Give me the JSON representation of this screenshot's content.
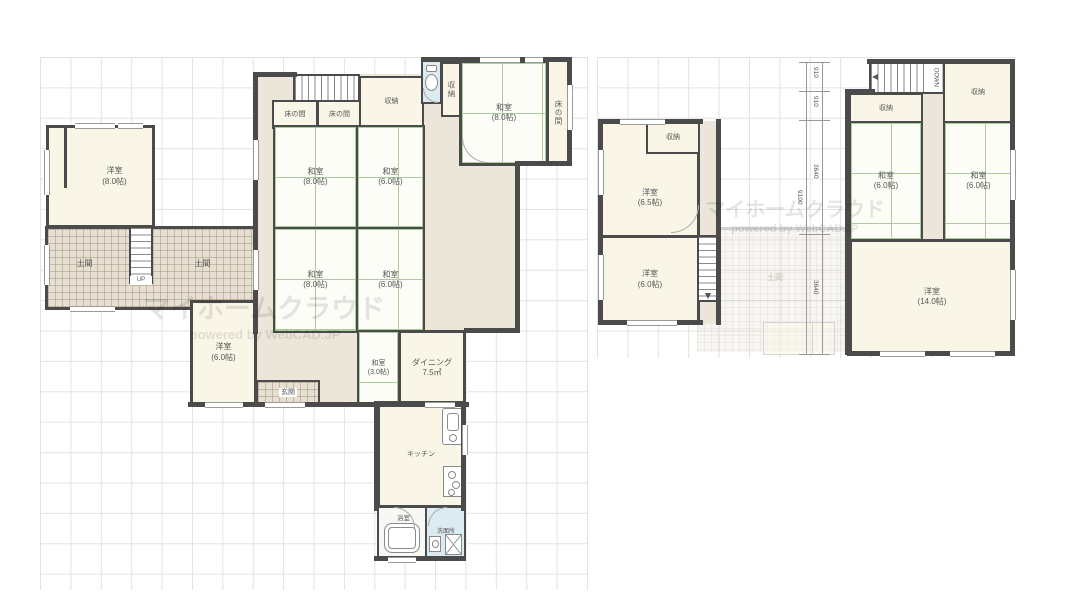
{
  "watermark": {
    "title": "マイホームクラウド",
    "subtitle": "powered by WebCAD.JP"
  },
  "floor1": {
    "rooms": {
      "yoshitsu8": {
        "name": "洋室",
        "size": "(8.0帖)"
      },
      "doma_left": {
        "name": "土間"
      },
      "doma_right": {
        "name": "土間"
      },
      "tokonoma_a": {
        "name": "床の間"
      },
      "tokonoma_b": {
        "name": "床の間"
      },
      "shuno_hall": {
        "name": "収納"
      },
      "shuno_tall": {
        "name": "収納"
      },
      "washitsu8_ne": {
        "name": "和室",
        "size": "(8.0帖)"
      },
      "tokonoma_east": {
        "name": "床の間"
      },
      "washitsu8_a": {
        "name": "和室",
        "size": "(8.0帖)"
      },
      "washitsu6_a": {
        "name": "和室",
        "size": "(6.0帖)"
      },
      "washitsu8_b": {
        "name": "和室",
        "size": "(8.0帖)"
      },
      "washitsu6_b": {
        "name": "和室",
        "size": "(6.0帖)"
      },
      "yoshitsu6": {
        "name": "洋室",
        "size": "(6.0帖)"
      },
      "genkan": {
        "name": "玄関"
      },
      "washitsu3": {
        "name": "和室",
        "size": "(3.0帖)"
      },
      "dining": {
        "name": "ダイニング",
        "size": "7.5㎡"
      },
      "kitchen": {
        "name": "キッチン"
      },
      "bath": {
        "name": "浴室"
      },
      "senmenjo": {
        "name": "洗面所"
      }
    },
    "stairs_up": "UP"
  },
  "floor2": {
    "rooms": {
      "yoshitsu65": {
        "name": "洋室",
        "size": "(6.5帖)"
      },
      "shuno_a": {
        "name": "収納"
      },
      "yoshitsu6": {
        "name": "洋室",
        "size": "(6.0帖)"
      },
      "shuno_b": {
        "name": "収納"
      },
      "shuno_c": {
        "name": "収納"
      },
      "washitsu6_w": {
        "name": "和室",
        "size": "(6.0帖)"
      },
      "washitsu6_e": {
        "name": "和室",
        "size": "(6.0帖)"
      },
      "yoshitsu14": {
        "name": "洋室",
        "size": "(14.0帖)"
      },
      "ghost_doma": {
        "name": "土間"
      }
    },
    "stairs_down": "DOWN",
    "dimensions": {
      "seg1": "910",
      "seg2": "910",
      "seg3": "3640",
      "seg4": "3640",
      "total": "9100"
    }
  },
  "palette": {
    "wall": "#4b4b4b",
    "tatami_line": "#aacd9b",
    "room_cream": "#faf6e7",
    "hall": "#ebe6d9",
    "water_blue": "#dcebf1",
    "doma": "#e7e0d2",
    "grid": "#e3e3e3"
  }
}
